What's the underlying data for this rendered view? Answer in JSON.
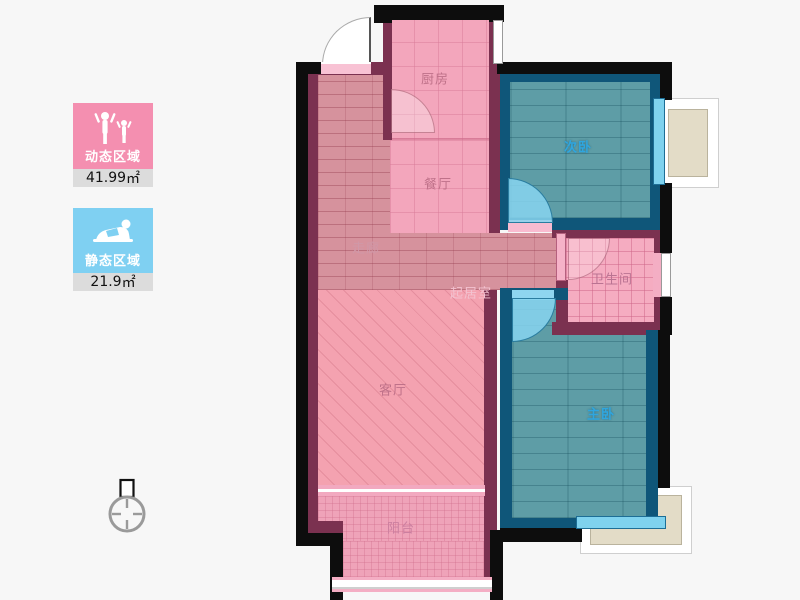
{
  "legend": {
    "dynamic": {
      "label": "动态区域",
      "value": "41.99",
      "unit": "㎡",
      "color": "#F48FB0"
    },
    "static": {
      "label": "静态区域",
      "value": "21.9",
      "unit": "㎡",
      "color": "#7FD0F2"
    }
  },
  "rooms": {
    "kitchen": "厨房",
    "dining": "餐厅",
    "corridor": "走廊",
    "foyer": "起居室",
    "living": "客厅",
    "balcony": "阳台",
    "bathroom": "卫生间",
    "second_bedroom": "次卧",
    "master_bedroom": "主卧"
  },
  "colors": {
    "outer_wall": "#0D0D0D",
    "pink_wall": "#7B3150",
    "blue_wall": "#0F5679",
    "pink_floor": "#F3A6BC",
    "teal_floor": "#5E9DA6",
    "window_blue": "#7FD2EE",
    "platform_beige": "#E3DCC7",
    "legend_value_bg": "#DCDCDC"
  }
}
